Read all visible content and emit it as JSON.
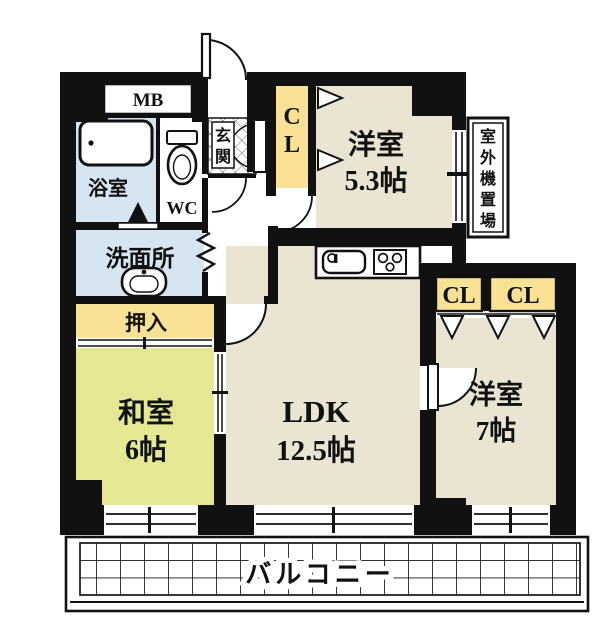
{
  "floorplan": {
    "unit_labels": {
      "mb": "MB",
      "bathroom": "浴室",
      "toilet": "WC",
      "entrance_chars": [
        "玄",
        "関"
      ],
      "washroom": "洗面所",
      "entrance_closet_chars": [
        "C",
        "L"
      ],
      "oshiire": "押入",
      "outdoor_unit_chars": [
        "室",
        "外",
        "機",
        "置",
        "場"
      ],
      "closet_a": "CL",
      "closet_b": "CL",
      "balcony": "バルコニー"
    },
    "rooms": [
      {
        "name": "洋室",
        "size": "5.3帖"
      },
      {
        "name": "LDK",
        "size": "12.5帖"
      },
      {
        "name": "洋室",
        "size": "7帖"
      },
      {
        "name": "和室",
        "size": "6帖"
      }
    ],
    "colors": {
      "wall": "#111111",
      "western_room_floor": "#EAE5D3",
      "tatami_floor": "#E6E792",
      "closet": "#F9E295",
      "wet_area": "#D6E5F2",
      "background": "#FFFFFF"
    }
  }
}
